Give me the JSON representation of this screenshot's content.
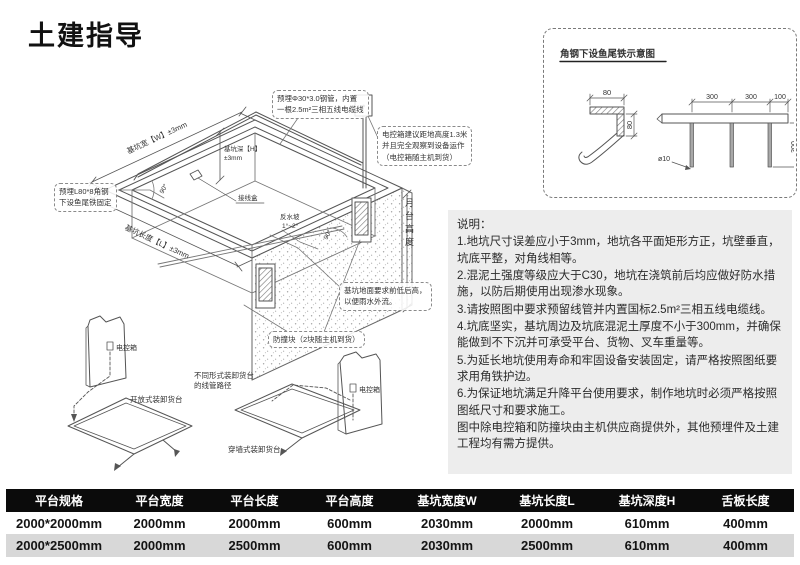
{
  "page": {
    "title": "土建指导"
  },
  "diagram": {
    "callout_pipe_line1": "预埋Φ30*3.0钢管，内置",
    "callout_pipe_line2": "一根2.5m²三相五线电缆线",
    "callout_box_line1": "电控箱建议距地高度1.3米",
    "callout_box_line2": "并且完全观察到设备运作",
    "callout_box_line3": "（电控箱随主机到货）",
    "callout_angle_line1": "预埋L80*8角钢",
    "callout_angle_line2": "下设鱼尾铁固定",
    "callout_ground_line1": "基坑地面要求前低后高，",
    "callout_ground_line2": "以便雨水外流。",
    "callout_bumper": "防撞块（2块随主机到货）",
    "dim_width": "基坑宽【W】±3mm",
    "dim_length": "基坑长度【L】±3mm",
    "dim_depth_line1": "基坑深【H】",
    "dim_depth_line2": "±3mm",
    "dim_dock_height": "月台高度",
    "junction_box": "接线盒",
    "slope_line1": "反水坡",
    "slope_line2": "1°~2°",
    "angle_left": "90°",
    "angle_right": "90°",
    "control_box_open": "电控箱",
    "control_box_wall": "电控箱",
    "label_open_dock": "开放式装卸货台",
    "label_wall_dock": "穿墙式装卸货台",
    "label_conduit_line1": "不同形式装卸货台",
    "label_conduit_line2": "的线管路径"
  },
  "detail": {
    "title": "角钢下设鱼尾铁示意图",
    "dim_80_top": "80",
    "dim_80_side": "80",
    "dim_300_a": "300",
    "dim_300_b": "300",
    "dim_100": "100",
    "dim_300_depth": "300",
    "dim_dia": "ø10"
  },
  "notes": {
    "title": "说明：",
    "items": [
      "1.地坑尺寸误差应小于3mm，地坑各平面矩形方正，坑壁垂直，坑底平整，对角线相等。",
      "2.混泥土强度等级应大于C30，地坑在浇筑前后均应做好防水措施，以防后期使用出现渗水现象。",
      "3.请按照图中要求预留线管并内置国标2.5m²三相五线电缆线。",
      "4.坑底坚实，基坑周边及坑底混泥土厚度不小于300mm，并确保能做到不下沉并可承受平台、货物、叉车重量等。",
      "5.为延长地坑使用寿命和牢固设备安装固定，请严格按照图纸要求用角铁护边。",
      "6.为保证地坑满足升降平台使用要求，制作地坑时必须严格按照图纸尺寸和要求施工。",
      "图中除电控箱和防撞块由主机供应商提供外，其他预埋件及土建工程均有需方提供。"
    ]
  },
  "table": {
    "headers": [
      "平台规格",
      "平台宽度",
      "平台长度",
      "平台高度",
      "基坑宽度W",
      "基坑长度L",
      "基坑深度H",
      "舌板长度"
    ],
    "rows": [
      [
        "2000*2000mm",
        "2000mm",
        "2000mm",
        "600mm",
        "2030mm",
        "2000mm",
        "610mm",
        "400mm"
      ],
      [
        "2000*2500mm",
        "2000mm",
        "2500mm",
        "600mm",
        "2030mm",
        "2500mm",
        "610mm",
        "400mm"
      ]
    ]
  },
  "colors": {
    "header_bg": "#0b0b0b",
    "row_alt_bg": "#d8d8d8",
    "line": "#555555"
  }
}
